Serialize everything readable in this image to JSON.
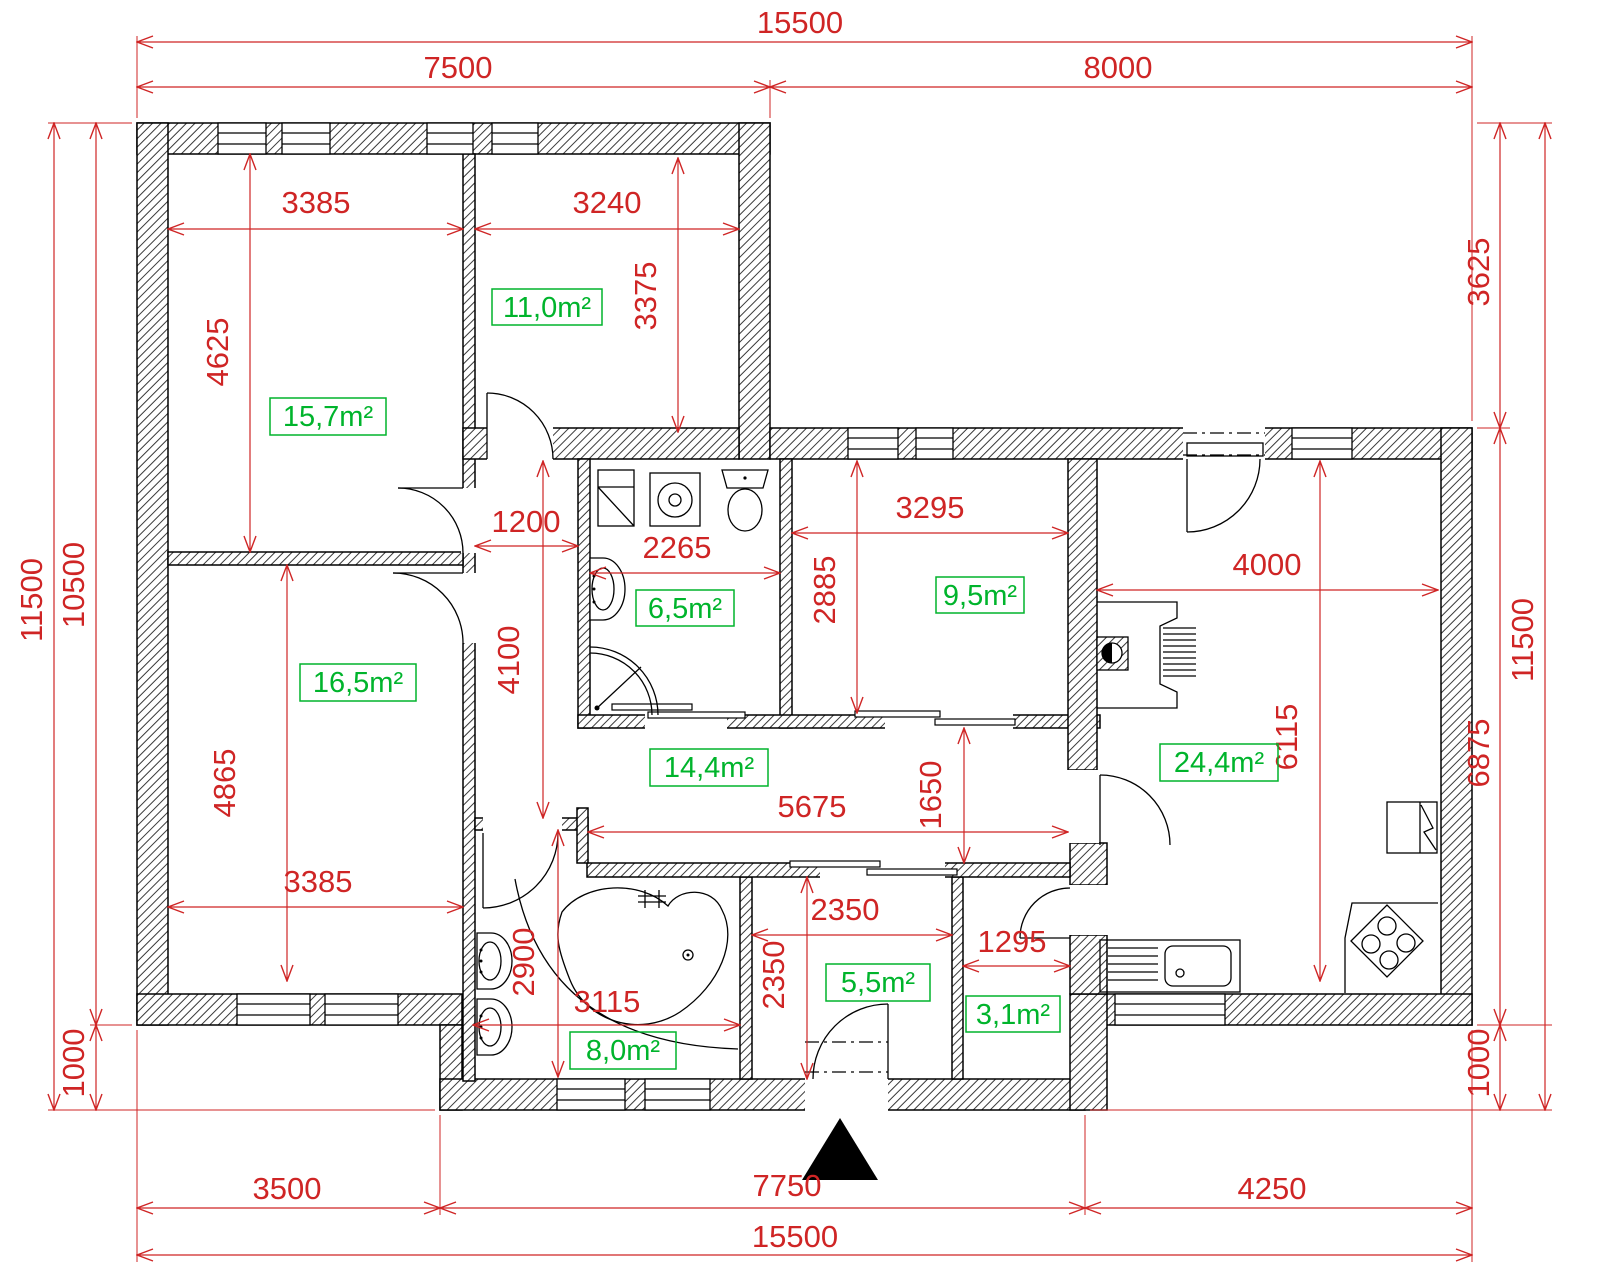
{
  "drawing": {
    "type": "architectural floor plan",
    "units": "mm"
  },
  "colors": {
    "dimension_red": "#cf2525",
    "area_green": "#00b42c",
    "lines_black": "#000000",
    "background": "#ffffff"
  },
  "dims": {
    "top_total": "15500",
    "top_left": "7500",
    "top_right": "8000",
    "left_total": "11500",
    "left_main": "10500",
    "left_porch": "1000",
    "right_offset": "3625",
    "right_main": "6875",
    "right_porch": "1000",
    "right_total": "11500",
    "bottom_left": "3500",
    "bottom_mid": "7750",
    "bottom_right": "4250",
    "bottom_total": "15500"
  },
  "rooms": {
    "bed1": {
      "area": "15,7m²",
      "w": "3385",
      "h": "4625"
    },
    "bed2": {
      "area": "11,0m²",
      "w": "3240",
      "h": "3375"
    },
    "bath_top": {
      "area": "6,5m²",
      "w": "2265"
    },
    "bed3": {
      "area": "9,5m²",
      "w": "3295",
      "h": "2885"
    },
    "living": {
      "area": "24,4m²",
      "w": "4000",
      "h": "6115"
    },
    "bed4": {
      "area": "16,5m²",
      "w": "3385",
      "h": "4865"
    },
    "hall": {
      "area": "14,4m²",
      "w": "5675",
      "h": "1650"
    },
    "bath_bottom": {
      "area": "8,0m²",
      "w": "3115",
      "h": "2900"
    },
    "vestibule": {
      "area": "5,5m²",
      "w": "2350",
      "h": "2350"
    },
    "pantry": {
      "area": "3,1m²",
      "w": "1295"
    },
    "corridor": {
      "w": "1200",
      "h": "4100"
    }
  }
}
